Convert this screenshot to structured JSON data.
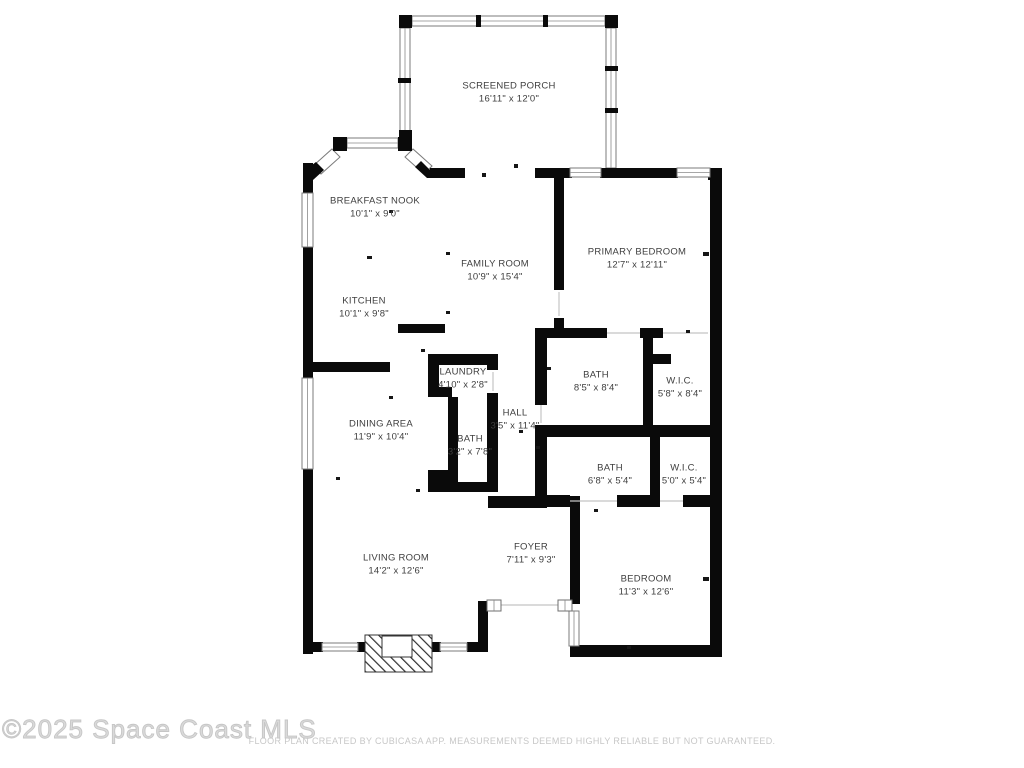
{
  "colors": {
    "wall": "#0a0a0a",
    "window_frame": "#7b7b7b",
    "label_text": "#3e3e3e",
    "watermark_text": "#c6c6c6",
    "disclaimer_text": "#c7c7c7",
    "background": "#ffffff"
  },
  "rooms": [
    {
      "name": "SCREENED PORCH",
      "dims": "16'11\" x 12'0\""
    },
    {
      "name": "BREAKFAST NOOK",
      "dims": "10'1\" x 9'0\""
    },
    {
      "name": "FAMILY ROOM",
      "dims": "10'9\" x 15'4\""
    },
    {
      "name": "PRIMARY BEDROOM",
      "dims": "12'7\" x 12'11\""
    },
    {
      "name": "KITCHEN",
      "dims": "10'1\" x 9'8\""
    },
    {
      "name": "LAUNDRY",
      "dims": "4'10\" x 2'8\""
    },
    {
      "name": "BATH",
      "dims": "8'5\" x 8'4\""
    },
    {
      "name": "W.I.C.",
      "dims": "5'8\" x 8'4\""
    },
    {
      "name": "HALL",
      "dims": "3'5\" x 11'4\""
    },
    {
      "name": "DINING AREA",
      "dims": "11'9\" x 10'4\""
    },
    {
      "name": "BATH",
      "dims": "3'2\" x 7'8\""
    },
    {
      "name": "BATH",
      "dims": "6'8\" x 5'4\""
    },
    {
      "name": "W.I.C.",
      "dims": "5'0\" x 5'4\""
    },
    {
      "name": "FOYER",
      "dims": "7'11\" x 9'3\""
    },
    {
      "name": "LIVING ROOM",
      "dims": "14'2\" x 12'6\""
    },
    {
      "name": "BEDROOM",
      "dims": "11'3\" x 12'6\""
    }
  ],
  "footer": {
    "watermark": "©2025 Space Coast MLS",
    "disclaimer": "FLOOR PLAN CREATED BY CUBICASA APP. MEASUREMENTS DEEMED HIGHLY RELIABLE BUT NOT GUARANTEED."
  }
}
